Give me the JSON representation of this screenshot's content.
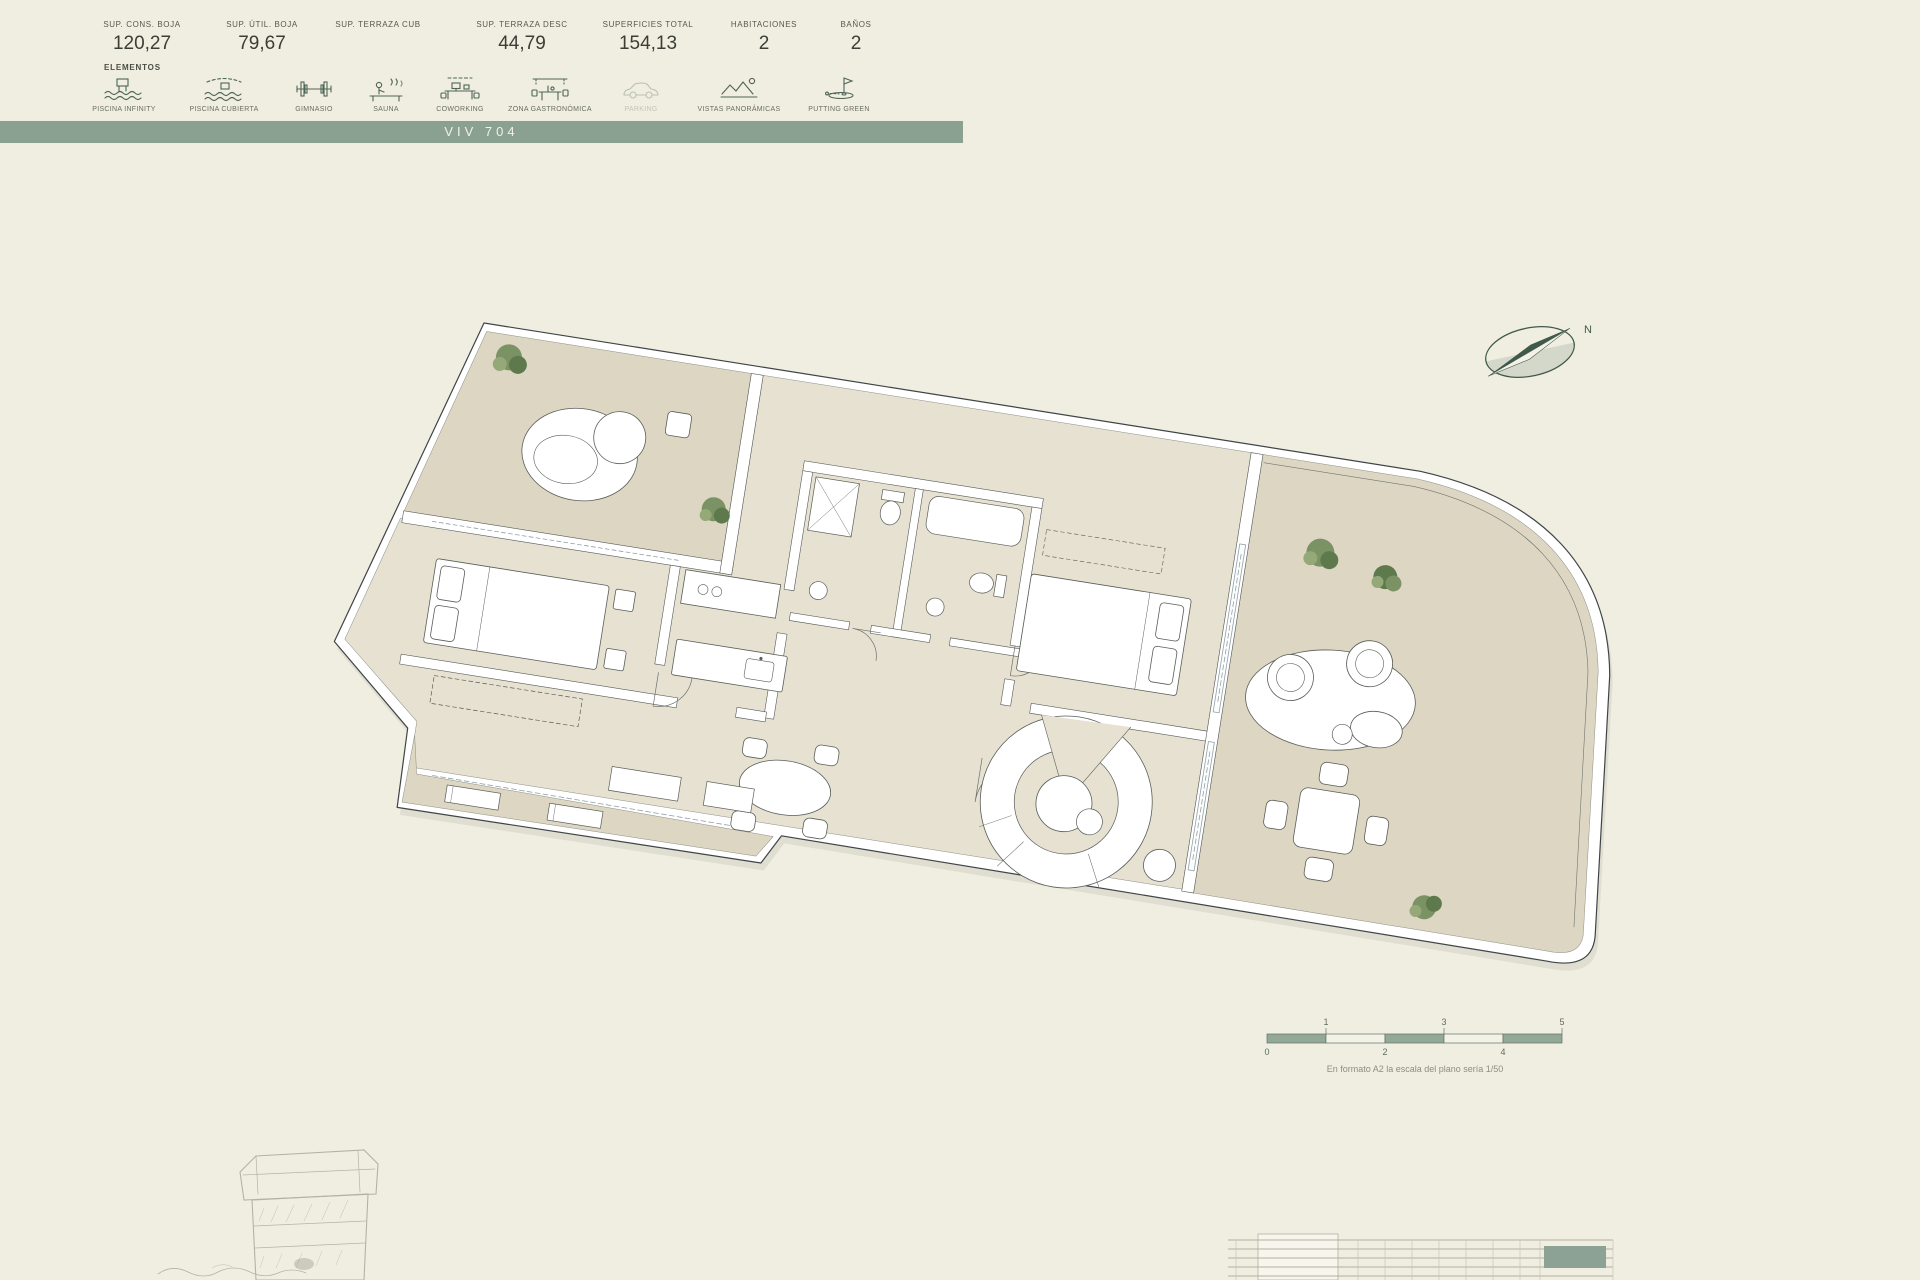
{
  "meta": {
    "background": "#f0eee1",
    "accent_green": "#8aa192",
    "line_green": "#4e6456",
    "ink": "#3b3e37"
  },
  "specs": {
    "columns": [
      {
        "label": "SUP. CONS. BOJA",
        "value": "120,27"
      },
      {
        "label": "SUP. ÚTIL. BOJA",
        "value": "79,67"
      },
      {
        "label": "SUP. TERRAZA CUB",
        "value": ""
      },
      {
        "label": "SUP. TERRAZA DESC",
        "value": "44,79"
      },
      {
        "label": "SUPERFICIES TOTAL",
        "value": "154,13"
      },
      {
        "label": "HABITACIONES",
        "value": "2"
      },
      {
        "label": "BAÑOS",
        "value": "2"
      }
    ]
  },
  "elements": {
    "title": "ELEMENTOS",
    "items": [
      {
        "label": "PISCINA INFINITY",
        "icon": "infinity-pool-icon",
        "active": true
      },
      {
        "label": "PISCINA CUBIERTA",
        "icon": "indoor-pool-icon",
        "active": true
      },
      {
        "label": "GIMNASIO",
        "icon": "gym-icon",
        "active": true
      },
      {
        "label": "SAUNA",
        "icon": "sauna-icon",
        "active": true
      },
      {
        "label": "COWORKING",
        "icon": "coworking-icon",
        "active": true
      },
      {
        "label": "ZONA GASTRONÓMICA",
        "icon": "gastro-zone-icon",
        "active": true
      },
      {
        "label": "PARKING",
        "icon": "parking-icon",
        "active": false
      },
      {
        "label": "VISTAS PANORÁMICAS",
        "icon": "panoramic-views-icon",
        "active": true
      },
      {
        "label": "PUTTING GREEN",
        "icon": "putting-green-icon",
        "active": true
      }
    ]
  },
  "unit_banner": {
    "label": "VIV 704"
  },
  "compass": {
    "north_label": "N"
  },
  "scale_bar": {
    "ticks_top": [
      "1",
      "3",
      "5"
    ],
    "ticks_bottom": [
      "0",
      "2",
      "4"
    ],
    "caption": "En formato A2 la escala del plano sería 1/50"
  }
}
